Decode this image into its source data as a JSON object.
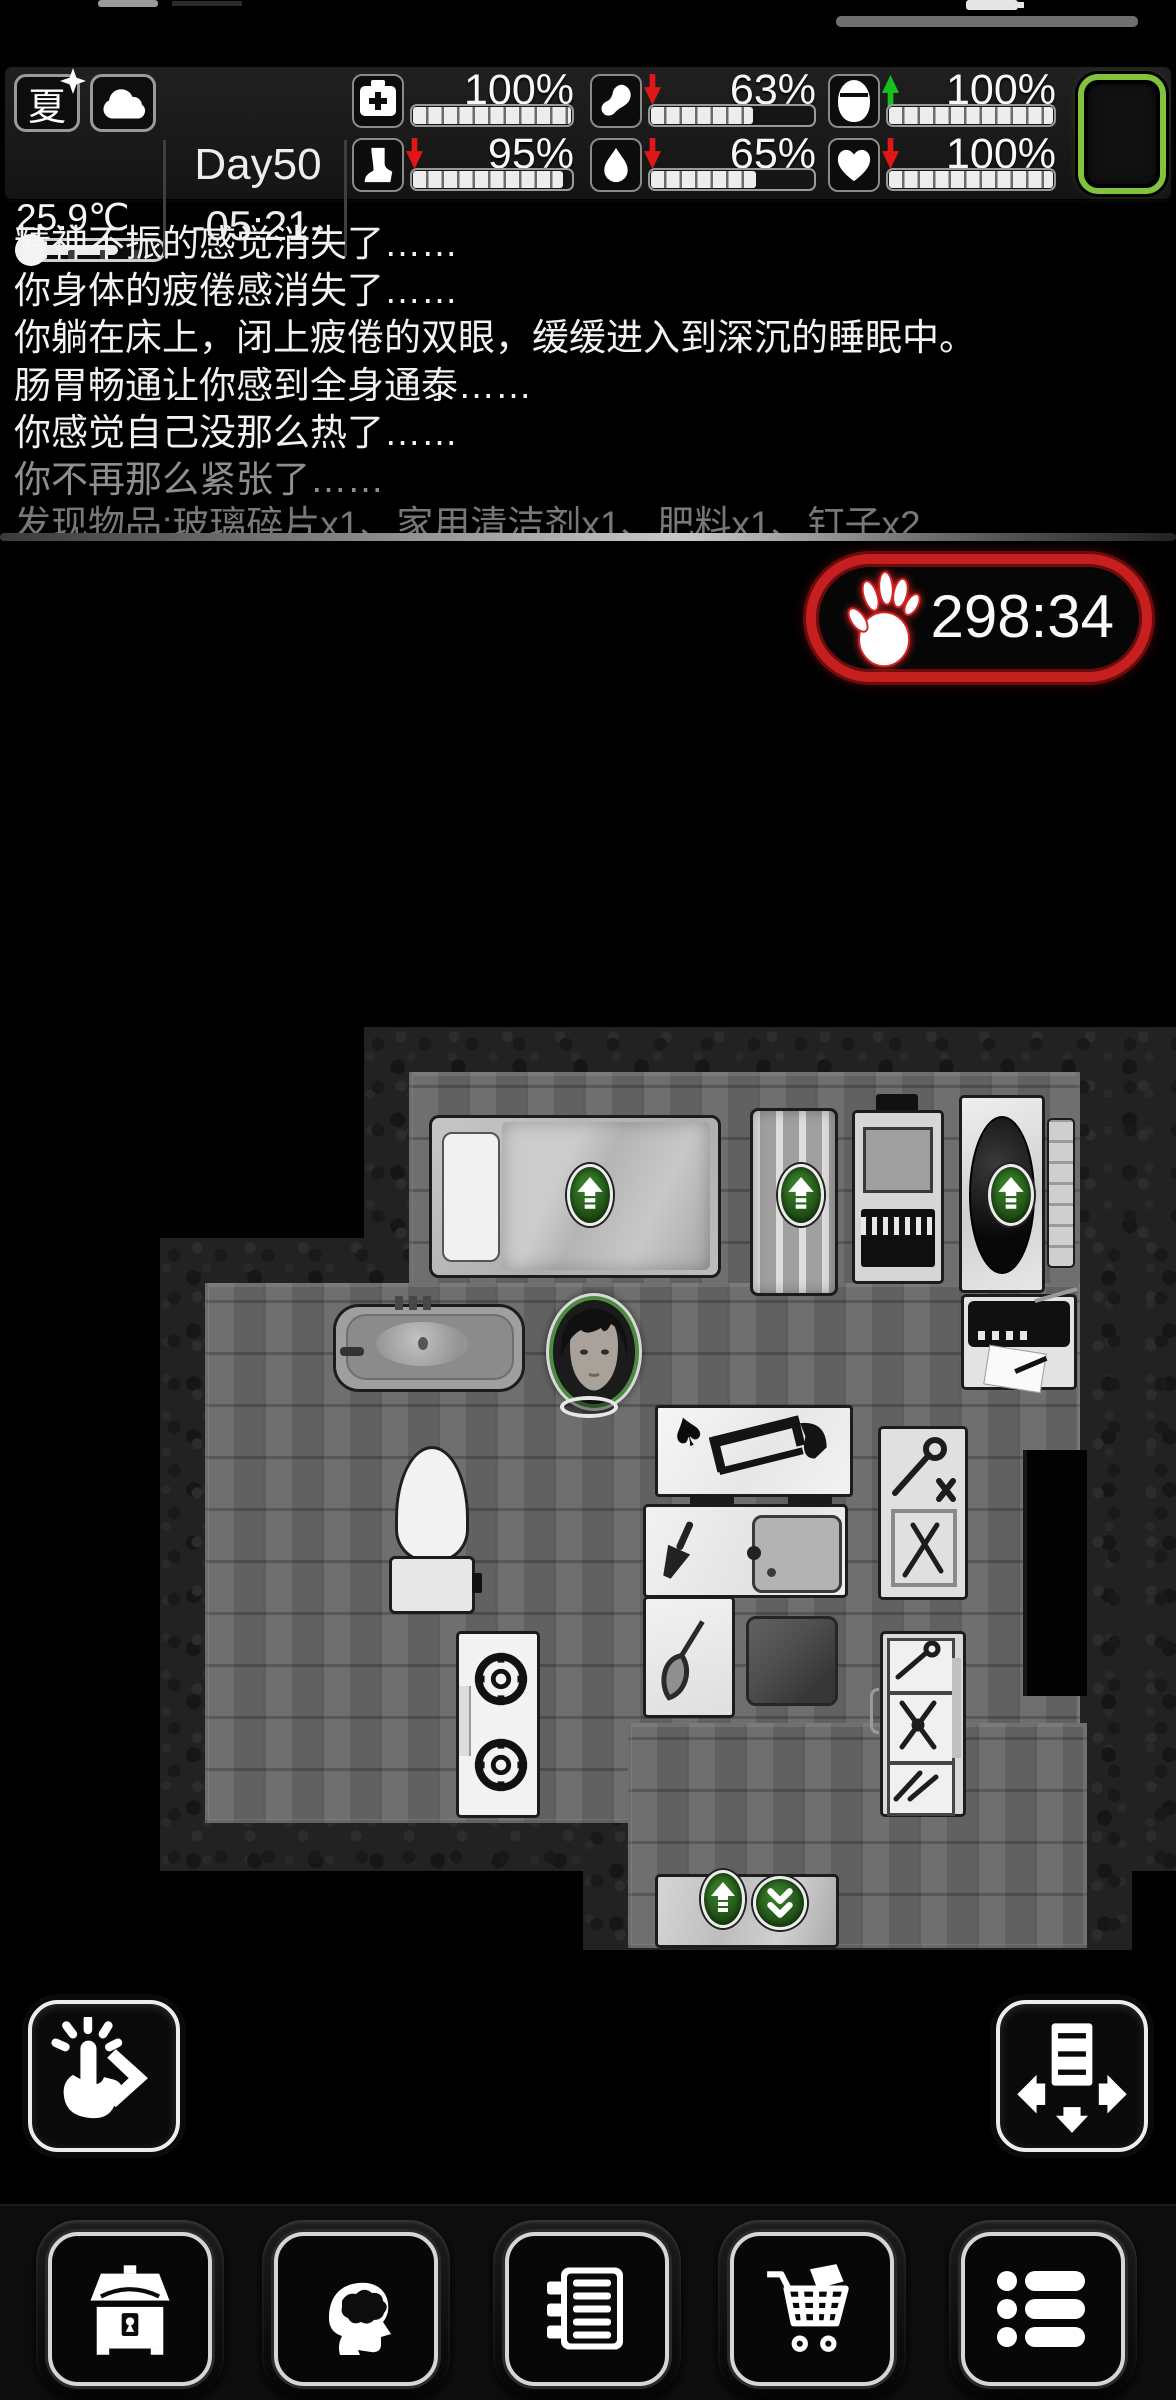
{
  "header": {
    "season_label": "夏",
    "weather": "cloudy",
    "temperature": "25.9℃",
    "thermometer_fill_pct": 55,
    "day_label": "Day50",
    "time_label": "-05:21-",
    "stats": [
      {
        "id": "health",
        "icon": "first-aid-icon",
        "value": "100%",
        "trend": "none",
        "fill": 100
      },
      {
        "id": "legs",
        "icon": "leg-icon",
        "value": "95%",
        "trend": "down",
        "fill": 95
      },
      {
        "id": "hunger",
        "icon": "stomach-icon",
        "value": "63%",
        "trend": "down",
        "fill": 63
      },
      {
        "id": "thirst",
        "icon": "water-drop-icon",
        "value": "65%",
        "trend": "down",
        "fill": 65
      },
      {
        "id": "energy",
        "icon": "sleep-head-icon",
        "value": "100%",
        "trend": "up",
        "fill": 100
      },
      {
        "id": "mood",
        "icon": "heart-icon",
        "value": "100%",
        "trend": "down",
        "fill": 100
      }
    ],
    "battery_accent": "#82c33e"
  },
  "log": {
    "lines": [
      "精神不振的感觉消失了……",
      "你身体的疲倦感消失了……",
      "你躺在床上，闭上疲倦的双眼，缓缓进入到深沉的睡眠中。",
      "肠胃畅通让你感到全身通泰……",
      "你感觉自己没那么热了……",
      "你不再那么紧张了……",
      "发现物品:玻璃碎片x1、家用清洁剂x1、肥料x1、钉子x2"
    ]
  },
  "infection_timer": {
    "value": "298:34",
    "accent": "#c51f1f",
    "icon": "zombie-hand-icon"
  },
  "map": {
    "player": "survivor-portrait",
    "badge_accent": "#2f7022",
    "objects": [
      "bed",
      "wardrobe",
      "workbench",
      "dark-tub",
      "shelf-panel",
      "radio-table",
      "bathtub",
      "toilet",
      "saw-table",
      "tool-rack",
      "doorway",
      "counter-with-sink",
      "floor-rug",
      "stove",
      "tool-cabinet",
      "exit-mat"
    ]
  },
  "action_buttons": {
    "left": "interact-next",
    "right": "move-furniture"
  },
  "bottom_bar": {
    "buttons": [
      {
        "name": "storage",
        "icon": "chest-icon"
      },
      {
        "name": "character",
        "icon": "brain-head-icon"
      },
      {
        "name": "journal",
        "icon": "notebook-icon"
      },
      {
        "name": "shopping",
        "icon": "cart-icon"
      },
      {
        "name": "menu",
        "icon": "list-icon"
      }
    ]
  }
}
